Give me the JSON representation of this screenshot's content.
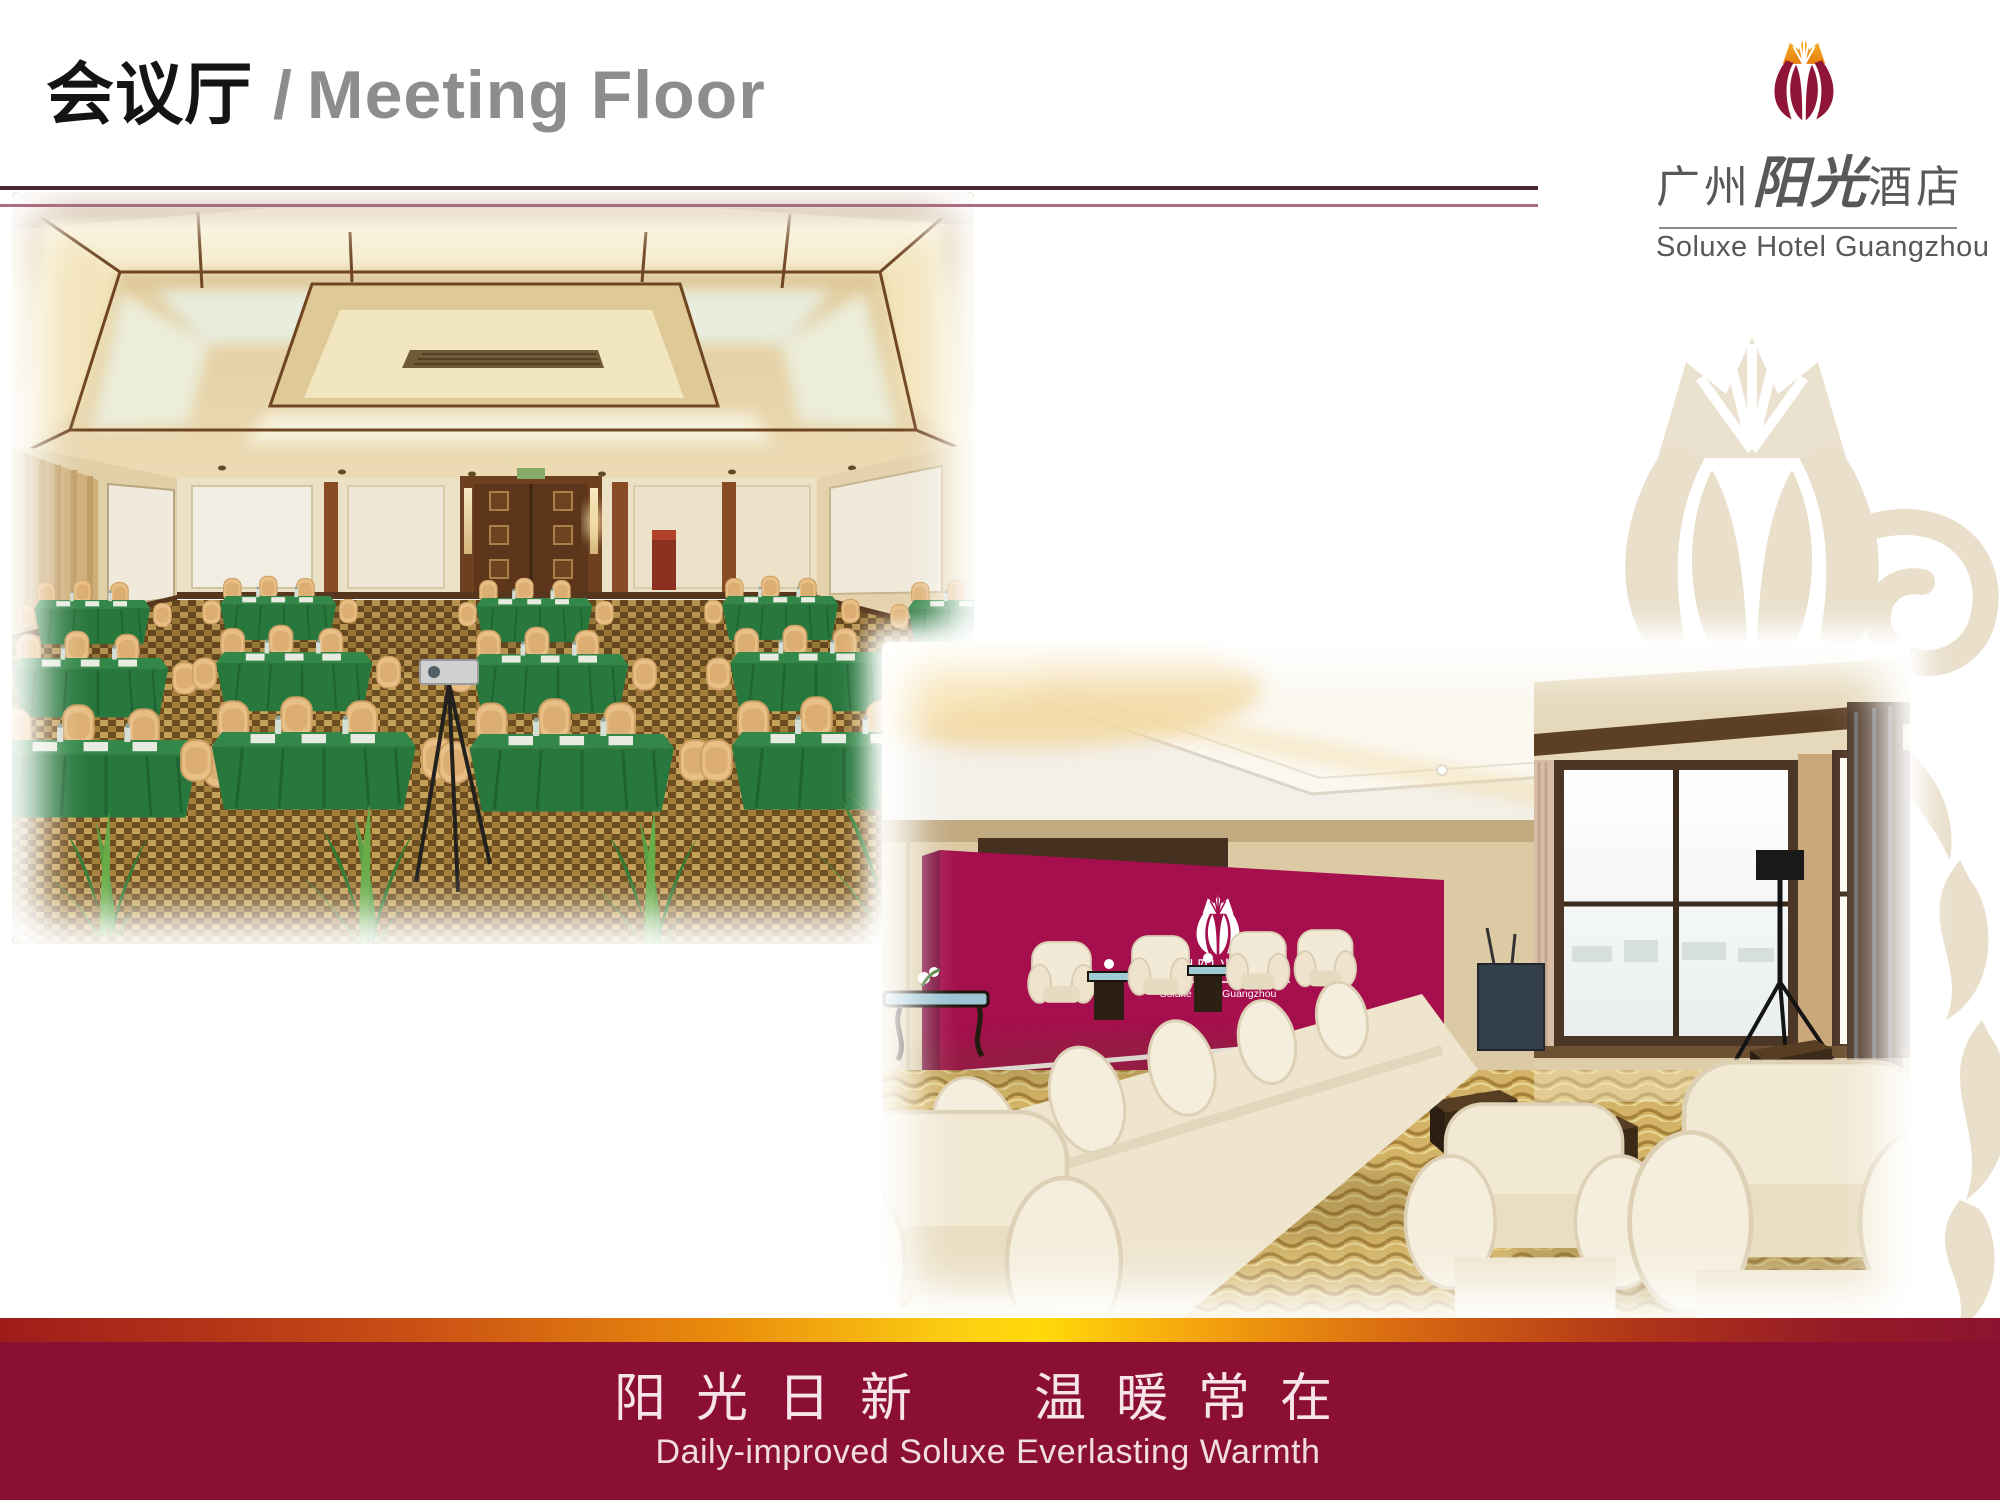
{
  "header": {
    "title_cn": "会议厅",
    "title_sep": "/",
    "title_en": "Meeting Floor",
    "rule_color_top": "#4b2836",
    "rule_color_bottom": "#ab6d82"
  },
  "logo": {
    "cn_city": "广州",
    "cn_script": "阳光",
    "cn_suffix": "酒店",
    "en": "Soluxe Hotel Guangzhou",
    "icon": "tulip-logo-icon",
    "petal_color": "#8e1538",
    "flame_color": "#f0920f",
    "text_color": "#57585a"
  },
  "photos": {
    "meeting_room": {
      "description": "Conference hall in classroom setup: rows of green-cloth tables with water bottles and papers, beige banquet chairs, glowing coffered ceiling, wood-panelled walls with double doors, patterned carpet, projector tripod and green plants in the foreground"
    },
    "lounge": {
      "description": "VIP reception lounge: cream roll-arm sofas and armchairs, dark wood coffee tables, floor-to-ceiling windows with daylight, golden wave-pattern carpet and a magenta Soluxe Hotel backdrop wall",
      "backdrop_cn": "广州阳光酒店",
      "backdrop_en": "Soluxe Hotel Guangzhou",
      "backdrop_color": "#a50f4d"
    }
  },
  "watermark": {
    "name": "tulip-flower-ornament",
    "color": "#e9dfcb"
  },
  "footer": {
    "cn_phrase_1": "阳光日新",
    "cn_phrase_2": "温暖常在",
    "en": "Daily-improved Soluxe Everlasting Warmth",
    "band_color": "#8a0f33",
    "gradient_colors": [
      "#9d1c1b",
      "#cc5414",
      "#fccf12",
      "#d96a12",
      "#8d1330"
    ]
  }
}
